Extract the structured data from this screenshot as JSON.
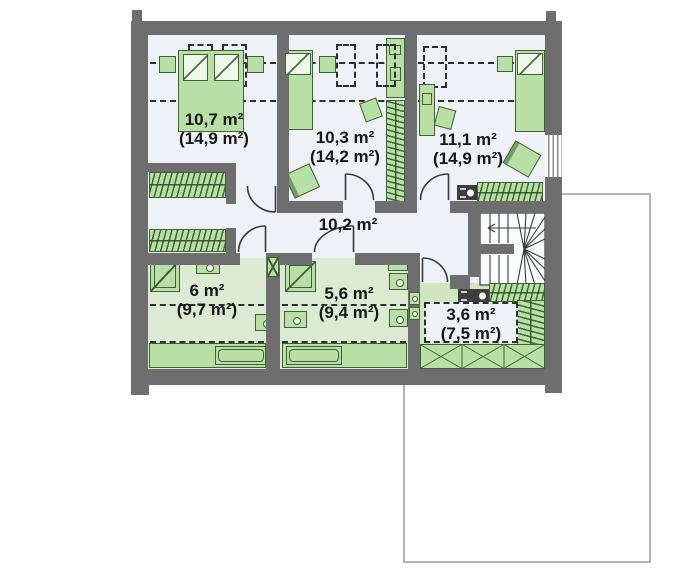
{
  "plan": {
    "type": "floor-plan",
    "floor": "attic-storey",
    "rooms": [
      {
        "id": "bedroom-1",
        "area": "10,7 m²",
        "gross_area": "(14,9 m²)"
      },
      {
        "id": "bedroom-2",
        "area": "10,3 m²",
        "gross_area": "(14,2 m²)"
      },
      {
        "id": "bedroom-3",
        "area": "11,1 m²",
        "gross_area": "(14,9 m²)"
      },
      {
        "id": "hall",
        "area": "10,2 m²",
        "gross_area": ""
      },
      {
        "id": "bathroom-1",
        "area": "6 m²",
        "gross_area": "(9,7 m²)"
      },
      {
        "id": "bathroom-2",
        "area": "5,6 m²",
        "gross_area": "(9,4 m²)"
      },
      {
        "id": "storage",
        "area": "3,6 m²",
        "gross_area": "(7,5 m²)"
      }
    ],
    "colors": {
      "wall": "#6e6e6e",
      "bedroom_floor": "#eef1f5",
      "bathroom_floor": "#dcead3",
      "storage_floor": "#cfe6c0",
      "furniture_fill": "#b9e0a4",
      "furniture_border": "#41603a",
      "roof_outline": "#b3b3b3",
      "label_text": "#161616"
    },
    "furniture": {
      "bedroom-1": [
        "double-bed",
        "nightstand",
        "nightstand",
        "wardrobe",
        "wardrobe",
        "skylight",
        "skylight"
      ],
      "bedroom-2": [
        "single-bed",
        "nightstand",
        "desk",
        "chair",
        "wardrobe",
        "armchair",
        "skylight",
        "skylight"
      ],
      "bedroom-3": [
        "single-bed",
        "nightstand",
        "desk",
        "chair",
        "armchair",
        "wardrobe",
        "appliance",
        "skylight",
        "window"
      ],
      "bathroom-1": [
        "shower",
        "washbasin",
        "toilet",
        "bathtub"
      ],
      "bathroom-2": [
        "shower",
        "washbasin",
        "washbasin",
        "toilet",
        "bathtub",
        "vent-shaft"
      ],
      "storage": [
        "wardrobe",
        "wardrobe",
        "appliance"
      ],
      "hall": [
        "winder-staircase",
        "heater",
        "heater"
      ]
    }
  }
}
